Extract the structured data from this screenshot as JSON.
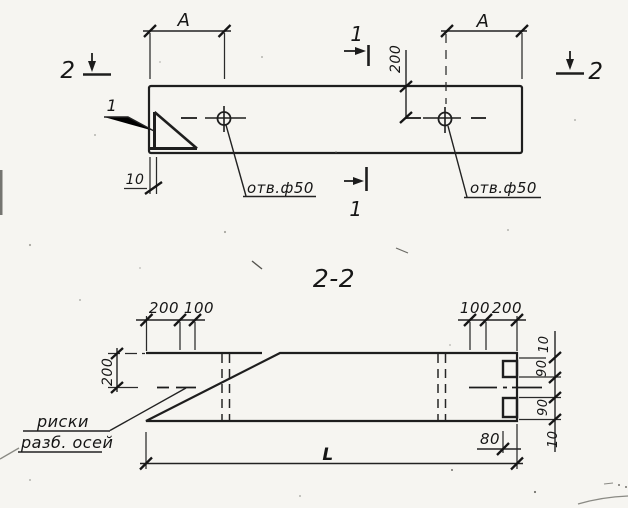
{
  "drawing": {
    "colors": {
      "ink": "#1c1c1c",
      "paper": "#f6f5f1"
    },
    "plan": {
      "mark_1_top": "1",
      "mark_1_bottom": "1",
      "mark_2_left": "2",
      "mark_2_right": "2",
      "dim_a_left": "А",
      "dim_a_right": "А",
      "dim_200": "200",
      "dim_10": "10",
      "callout_1": "1",
      "hole_label_left": "отв.ф50",
      "hole_label_right": "отв.ф50"
    },
    "section": {
      "title": "2-2",
      "dim_200_left": "200",
      "top_left": [
        "200",
        "100"
      ],
      "top_right": [
        "100",
        "200"
      ],
      "right_chain": [
        "10",
        "90",
        "90",
        "10"
      ],
      "dim_80": "80",
      "dim_length": "L",
      "note_line1": "риски",
      "note_line2": "разб. осей"
    }
  }
}
